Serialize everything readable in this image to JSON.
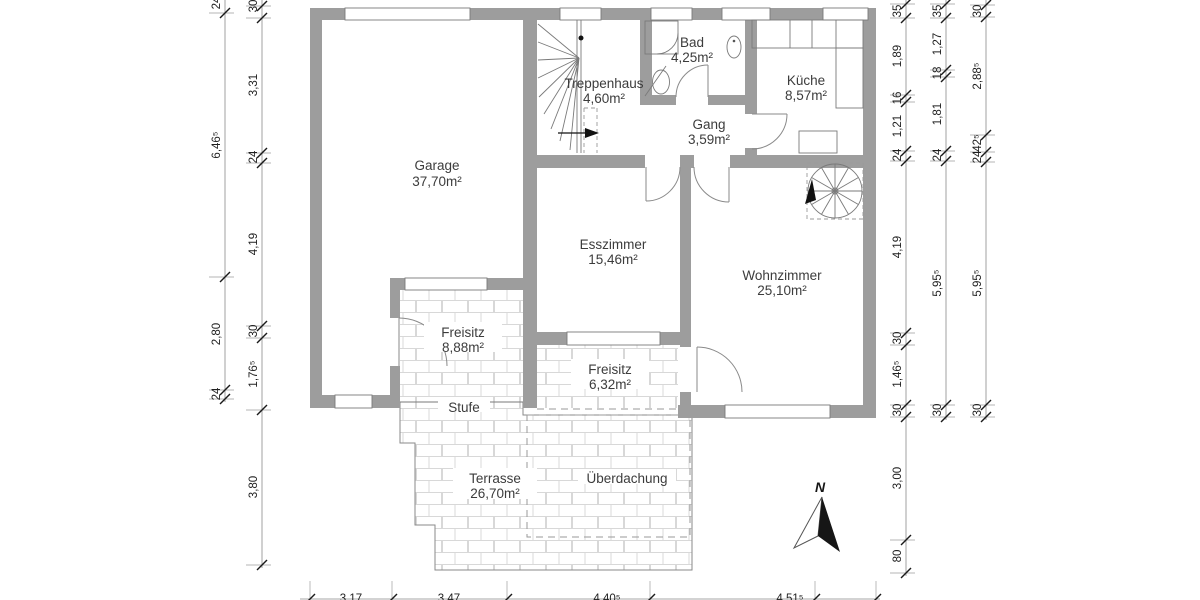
{
  "plan": {
    "rooms": [
      {
        "name": "Garage",
        "area": "37,70m²"
      },
      {
        "name": "Treppenhaus",
        "area": "4,60m²"
      },
      {
        "name": "Bad",
        "area": "4,25m²"
      },
      {
        "name": "Küche",
        "area": "8,57m²"
      },
      {
        "name": "Gang",
        "area": "3,59m²"
      },
      {
        "name": "Esszimmer",
        "area": "15,46m²"
      },
      {
        "name": "Wohnzimmer",
        "area": "25,10m²"
      },
      {
        "name": "Freisitz",
        "area": "8,88m²"
      },
      {
        "name": "Freisitz",
        "area": "6,32m²"
      },
      {
        "name": "Terrasse",
        "area": "26,70m²"
      }
    ],
    "labels": {
      "stufe": "Stufe",
      "ueberdachung": "Überdachung",
      "north": "N"
    }
  },
  "dimensions": {
    "left_outer": [
      "24",
      "6,46⁵",
      "2,80",
      "24"
    ],
    "left_inner": [
      "30",
      "3,31",
      "24",
      "4,19",
      "30",
      "1,76⁵",
      "3,80"
    ],
    "right_inner": [
      "35",
      "1,89",
      "16",
      "1,21",
      "24",
      "4,19",
      "30",
      "1,46⁵",
      "30",
      "3,00",
      "80"
    ],
    "right_middle": [
      "35",
      "1,27",
      "18",
      "1,81",
      "24",
      "5,95⁵",
      "30"
    ],
    "right_outer": [
      "30",
      "2,88⁵",
      "42⁵",
      "24",
      "5,95⁵",
      "30"
    ],
    "bottom": [
      "3,17",
      "3,47",
      "4,40⁵",
      "4,51⁵"
    ]
  },
  "colors": {
    "wall": "#9d9d9d",
    "line": "#7a7a7a",
    "hatch": "#d8d8d8",
    "text": "#3c3c3c"
  }
}
